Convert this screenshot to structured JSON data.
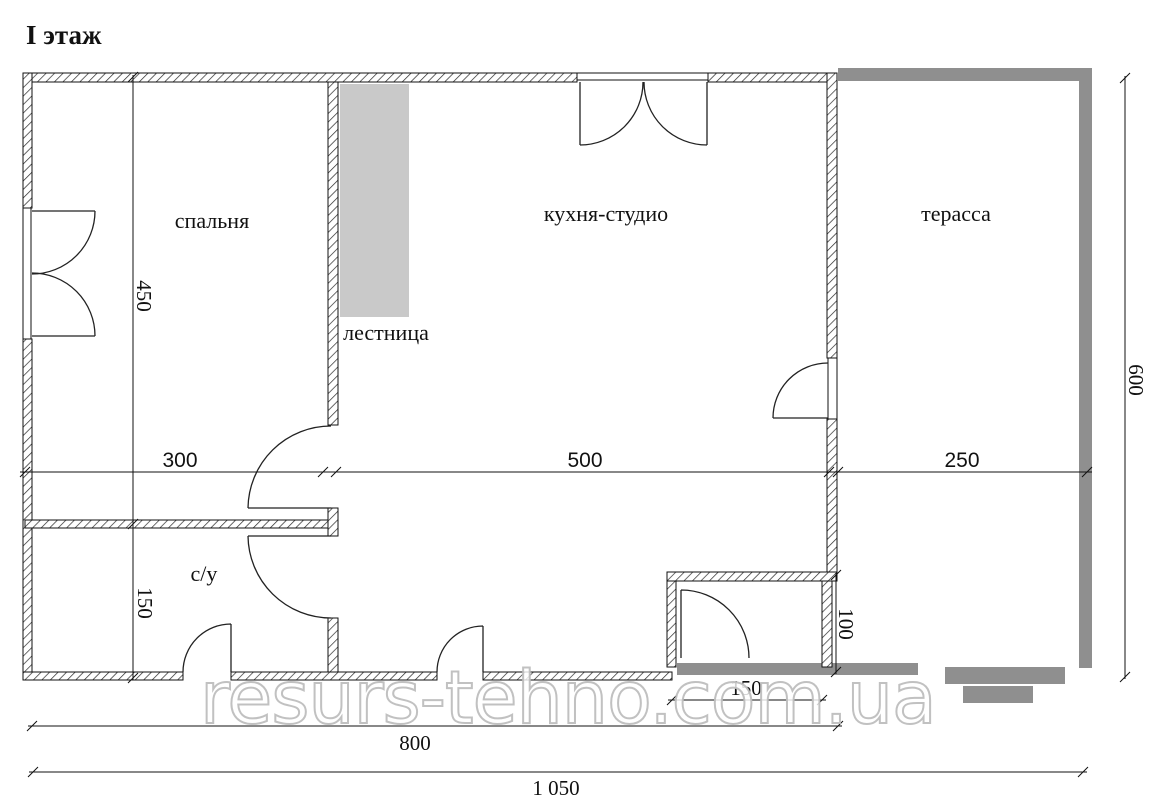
{
  "title": "I этаж",
  "watermark": "resurs-tehno.com.ua",
  "rooms": {
    "bedroom": "спальня",
    "kitchen": "кухня-студио",
    "terrace": "терасса",
    "stairs": "лестница",
    "bathroom": "с/у"
  },
  "dims": {
    "bedroom_depth": "450",
    "bedroom_width": "300",
    "kitchen_width": "500",
    "terrace_width": "250",
    "house_depth": "600",
    "bathroom_depth": "150",
    "entry_depth": "100",
    "entry_width": "150",
    "inner_width": "800",
    "total_width": "1 050"
  },
  "colors": {
    "wall_line": "#111111",
    "terrace_gray": "#8f8f8f",
    "stairs_gray": "#c9c9c9",
    "watermark_gray": "#bebebe"
  }
}
